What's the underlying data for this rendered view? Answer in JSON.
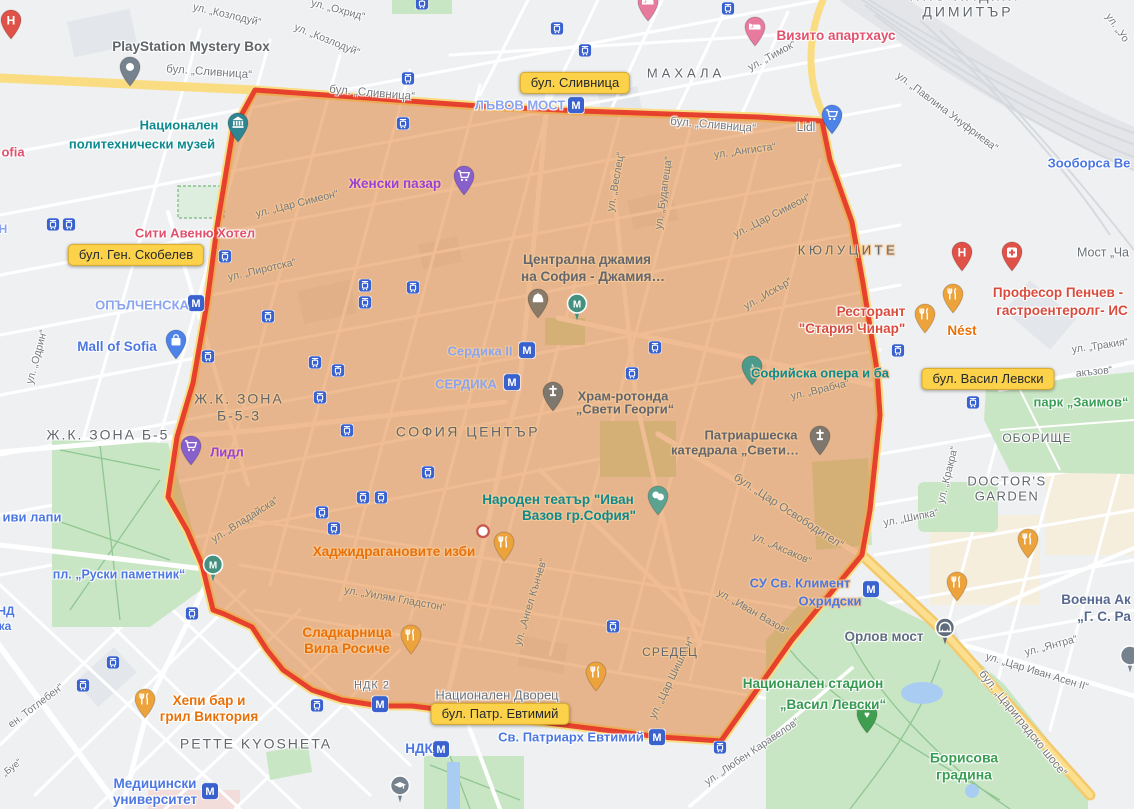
{
  "map": {
    "city": "София",
    "zone_stroke": "#e53b2c",
    "zone_fill": "#e07a28",
    "badge_bg": "#fcd24a"
  },
  "badges": [
    {
      "t": "бул. Сливница",
      "x": 575,
      "y": 83,
      "n": "badge-slivnitsa"
    },
    {
      "t": "бул. Ген. Скобелев",
      "x": 136,
      "y": 255,
      "n": "badge-skobelev"
    },
    {
      "t": "бул. Васил Левски",
      "x": 988,
      "y": 379,
      "n": "badge-vasil-levski"
    },
    {
      "t": "бул. Патр. Евтимий",
      "x": 500,
      "y": 714,
      "n": "badge-patr-evtimiy"
    }
  ],
  "labels": [
    {
      "t": "ул. „Козлодуй“",
      "x": 227,
      "y": 15,
      "k": "street",
      "r": 13
    },
    {
      "t": "ул. „Охрид“",
      "x": 338,
      "y": 10,
      "k": "street",
      "r": 15
    },
    {
      "t": "ул. „Козлодуй“",
      "x": 327,
      "y": 40,
      "k": "street",
      "r": 22
    },
    {
      "t": "бул. „Сливница“",
      "x": 209,
      "y": 73,
      "k": "street",
      "r": 4,
      "s": 11.5
    },
    {
      "t": "бул. „Сливница“",
      "x": 372,
      "y": 94,
      "k": "street",
      "r": 5,
      "s": 11.5
    },
    {
      "t": "бул. „Сливница“",
      "x": 713,
      "y": 126,
      "k": "street",
      "r": 5,
      "s": 11.5
    },
    {
      "t": "ул. „Тимок“",
      "x": 772,
      "y": 56,
      "k": "street",
      "r": -28
    },
    {
      "t": "ул. „Павлина Унуфриева“",
      "x": 947,
      "y": 112,
      "k": "street",
      "r": 37
    },
    {
      "t": "ул. „Уо",
      "x": 1117,
      "y": 28,
      "k": "street",
      "r": 55
    },
    {
      "t": "ул. „Ангиста“",
      "x": 745,
      "y": 151,
      "k": "street",
      "r": -8,
      "h": 1
    },
    {
      "t": "ул. „Цар Симеон“",
      "x": 297,
      "y": 204,
      "k": "street",
      "r": -14,
      "h": 1
    },
    {
      "t": "ул. „Цар Симеон“",
      "x": 772,
      "y": 216,
      "k": "street",
      "r": -27,
      "h": 1
    },
    {
      "t": "ул. „Веслец“",
      "x": 616,
      "y": 182,
      "k": "street",
      "r": -80,
      "h": 1
    },
    {
      "t": "ул. „Будапеща“",
      "x": 664,
      "y": 193,
      "k": "street",
      "r": -82,
      "h": 1
    },
    {
      "t": "ул. „Пиротска“",
      "x": 262,
      "y": 270,
      "k": "street",
      "r": -13,
      "h": 1
    },
    {
      "t": "ул. „Искър“",
      "x": 768,
      "y": 294,
      "k": "street",
      "r": -30,
      "h": 1
    },
    {
      "t": "ул. „Врабча“",
      "x": 820,
      "y": 390,
      "k": "street",
      "r": -13,
      "h": 1
    },
    {
      "t": "ул. „Одрин“",
      "x": 37,
      "y": 357,
      "k": "street",
      "r": -75
    },
    {
      "t": "ул. „Тракия“",
      "x": 1100,
      "y": 346,
      "k": "street",
      "r": -8
    },
    {
      "t": "акъзов“",
      "x": 1094,
      "y": 372,
      "k": "street",
      "r": -6
    },
    {
      "t": "ул. „Кракра“",
      "x": 948,
      "y": 475,
      "k": "street",
      "r": -76
    },
    {
      "t": "ул. „Шипка“",
      "x": 911,
      "y": 518,
      "k": "street",
      "r": -11
    },
    {
      "t": "бул. „Цар Освободител“",
      "x": 788,
      "y": 512,
      "k": "street",
      "r": 33,
      "s": 11.5,
      "h": 1
    },
    {
      "t": "ул. „Аксаков“",
      "x": 782,
      "y": 549,
      "k": "street",
      "r": 24,
      "h": 1
    },
    {
      "t": "ул. „Иван Вазов“",
      "x": 753,
      "y": 612,
      "k": "street",
      "r": 30,
      "h": 1
    },
    {
      "t": "ул. „Цар Шишман“",
      "x": 672,
      "y": 678,
      "k": "street",
      "r": -64,
      "h": 1
    },
    {
      "t": "ул. „Ангел Кънчев“",
      "x": 531,
      "y": 602,
      "k": "street",
      "r": -73,
      "h": 1
    },
    {
      "t": "ул. „Уилям Гладстон“",
      "x": 395,
      "y": 599,
      "k": "street",
      "r": 10,
      "h": 1
    },
    {
      "t": "ул. „Владайска“",
      "x": 245,
      "y": 520,
      "k": "street",
      "r": -32,
      "h": 1
    },
    {
      "t": "ул. „Любен Каравелов“",
      "x": 752,
      "y": 752,
      "k": "street",
      "r": -34
    },
    {
      "t": "ул. „Янтра“",
      "x": 1051,
      "y": 646,
      "k": "street",
      "r": -15
    },
    {
      "t": "ул. „Цар Иван Асен II“",
      "x": 1037,
      "y": 672,
      "k": "street",
      "r": 17
    },
    {
      "t": "бул. „Цариградско шосе“",
      "x": 1022,
      "y": 724,
      "k": "street",
      "r": 51,
      "s": 11.5
    },
    {
      "t": "ен. Тотлебен“",
      "x": 36,
      "y": 706,
      "k": "street",
      "r": -37
    },
    {
      "t": "„Буе“",
      "x": 12,
      "y": 768,
      "k": "street",
      "r": -38,
      "s": 9.5
    },
    {
      "t": "Мост „Ча",
      "x": 1103,
      "y": 253,
      "k": "dim",
      "s": 12.5
    },
    {
      "t": "Lidl",
      "x": 806,
      "y": 127,
      "k": "dim",
      "s": 12
    },
    {
      "t": "НДК 2",
      "x": 372,
      "y": 686,
      "k": "dim",
      "s": 11,
      "ls": 1
    },
    {
      "t": "Национален Дворец",
      "x": 497,
      "y": 695,
      "k": "dim",
      "s": 13
    },
    {
      "t": "НПЗ ХАДЖИ",
      "x": 965,
      "y": -4,
      "k": "area",
      "s": 14,
      "ls": 3
    },
    {
      "t": "ДИМИТЪР",
      "x": 968,
      "y": 12,
      "k": "area",
      "s": 14,
      "ls": 3
    },
    {
      "t": "МАХАЛА",
      "x": 686,
      "y": 73,
      "k": "area",
      "s": 13,
      "ls": 4
    },
    {
      "t": "КЮЛУЦИТЕ",
      "x": 848,
      "y": 250,
      "k": "area",
      "s": 13,
      "ls": 3.5,
      "h": 1
    },
    {
      "t": "Ж.К. ЗОНА Б-5",
      "x": 108,
      "y": 435,
      "k": "area",
      "s": 14,
      "ls": 2
    },
    {
      "t": "Ж.К. ЗОНА\nБ-5-3",
      "x": 239,
      "y": 407,
      "k": "area",
      "s": 14,
      "ls": 2,
      "h": 1
    },
    {
      "t": "СОФИЯ ЦЕНТЪР",
      "x": 468,
      "y": 432,
      "k": "area",
      "s": 14,
      "ls": 2.5,
      "h": 1
    },
    {
      "t": "СРЕДЕЦ",
      "x": 670,
      "y": 652,
      "k": "area",
      "s": 12,
      "ls": 1,
      "h": 1
    },
    {
      "t": "PETTE KYOSHETA",
      "x": 256,
      "y": 744,
      "k": "area",
      "s": 14,
      "ls": 2
    },
    {
      "t": "ОБОРИЩЕ",
      "x": 1037,
      "y": 438,
      "k": "area",
      "s": 12,
      "ls": 1
    },
    {
      "t": "DOCTOR'S\nGARDEN",
      "x": 1007,
      "y": 489,
      "k": "area",
      "s": 13,
      "ls": 1.5
    },
    {
      "t": "ЛЪВОВ МОСТ",
      "x": 520,
      "y": 105,
      "k": "stationlight",
      "s": 13
    },
    {
      "t": "ОПЪЛЧЕНСКА",
      "x": 142,
      "y": 305,
      "k": "stationlight",
      "s": 13
    },
    {
      "t": "Сердика II",
      "x": 480,
      "y": 351,
      "k": "stationlight",
      "s": 13,
      "h": 1
    },
    {
      "t": "СЕРДИКА",
      "x": 466,
      "y": 384,
      "k": "stationlight",
      "s": 13,
      "h": 1
    },
    {
      "t": "Н",
      "x": 3,
      "y": 229,
      "k": "stationlight",
      "s": 12
    },
    {
      "t": "Mall of Sofia",
      "x": 117,
      "y": 347,
      "k": "station",
      "s": 13.5
    },
    {
      "t": "иви лапи",
      "x": 32,
      "y": 517,
      "k": "station",
      "s": 13
    },
    {
      "t": "пл. „Руски паметник“",
      "x": 119,
      "y": 575,
      "k": "station",
      "s": 12.5
    },
    {
      "t": "Зооборса Ве",
      "x": 1089,
      "y": 163,
      "k": "station",
      "s": 13
    },
    {
      "t": "НД",
      "x": 6,
      "y": 611,
      "k": "station",
      "s": 12
    },
    {
      "t": "ка",
      "x": 5,
      "y": 626,
      "k": "station",
      "s": 12
    },
    {
      "t": "СУ Св. Климент",
      "x": 800,
      "y": 583,
      "k": "station",
      "s": 13,
      "h": 1
    },
    {
      "t": "Охридски",
      "x": 830,
      "y": 601,
      "k": "station",
      "s": 13,
      "h": 1
    },
    {
      "t": "Св. Патриарх Евтимий",
      "x": 571,
      "y": 737,
      "k": "station",
      "s": 13
    },
    {
      "t": "НДК",
      "x": 419,
      "y": 749,
      "k": "station",
      "s": 13.5
    },
    {
      "t": "Медицински\nуниверситет",
      "x": 155,
      "y": 792,
      "k": "station",
      "s": 13.5
    },
    {
      "t": "Национален",
      "x": 179,
      "y": 125,
      "k": "teal",
      "s": 13
    },
    {
      "t": "политехнически музей",
      "x": 142,
      "y": 144,
      "k": "teal",
      "s": 13
    },
    {
      "t": "Народен театър \"Иван",
      "x": 558,
      "y": 500,
      "k": "teal",
      "s": 13.5,
      "h": 1
    },
    {
      "t": "Вазов гр.София\"",
      "x": 579,
      "y": 516,
      "k": "teal",
      "s": 13.5,
      "h": 1
    },
    {
      "t": "Софийска опера и ба",
      "x": 820,
      "y": 373,
      "k": "teal",
      "s": 13,
      "h": 1
    },
    {
      "t": "Централна джамия",
      "x": 587,
      "y": 260,
      "k": "poigray",
      "s": 13.5,
      "h": 1
    },
    {
      "t": "на София - Джамия…",
      "x": 593,
      "y": 277,
      "k": "poigray",
      "s": 13.5,
      "h": 1
    },
    {
      "t": "Храм-ротонда",
      "x": 623,
      "y": 396,
      "k": "poigray",
      "s": 13,
      "h": 1
    },
    {
      "t": "„Свети Георги“",
      "x": 625,
      "y": 409,
      "k": "poigray",
      "s": 13,
      "h": 1
    },
    {
      "t": "Патриаршеска",
      "x": 751,
      "y": 435,
      "k": "poigray",
      "s": 13,
      "h": 1
    },
    {
      "t": "катедрала „Свети…",
      "x": 735,
      "y": 450,
      "k": "poigray",
      "s": 13,
      "h": 1
    },
    {
      "t": "PlayStation Mystery Box",
      "x": 191,
      "y": 47,
      "k": "gray",
      "s": 13.5
    },
    {
      "t": "Орлов мост",
      "x": 884,
      "y": 637,
      "k": "slate",
      "s": 13.5
    },
    {
      "t": "Военна Ак",
      "x": 1096,
      "y": 600,
      "k": "navy",
      "s": 13.5
    },
    {
      "t": "„Г. С. Ра",
      "x": 1104,
      "y": 617,
      "k": "navy",
      "s": 13.5
    },
    {
      "t": "парк „Заимов“",
      "x": 1081,
      "y": 402,
      "k": "green",
      "s": 13
    },
    {
      "t": "Борисова\nградина",
      "x": 964,
      "y": 766,
      "k": "green",
      "s": 14
    },
    {
      "t": "Национален стадион",
      "x": 813,
      "y": 684,
      "k": "greendark",
      "s": 13.5
    },
    {
      "t": "„Васил Левски“",
      "x": 833,
      "y": 705,
      "k": "greendark",
      "s": 13.5
    },
    {
      "t": "Женски пазар",
      "x": 395,
      "y": 184,
      "k": "purple",
      "s": 13.5,
      "h": 1
    },
    {
      "t": "Лидл",
      "x": 227,
      "y": 452,
      "k": "purple",
      "s": 13,
      "h": 1
    },
    {
      "t": "Хаджидрагановите изби",
      "x": 394,
      "y": 552,
      "k": "orange",
      "s": 13.5,
      "h": 1
    },
    {
      "t": "Сладкарница\nВила Росиче",
      "x": 347,
      "y": 641,
      "k": "orange",
      "s": 13.5,
      "h": 1
    },
    {
      "t": "Хепи бар и\nгрил Виктория",
      "x": 209,
      "y": 709,
      "k": "orange",
      "s": 13.5
    },
    {
      "t": "Nést",
      "x": 962,
      "y": 331,
      "k": "orange",
      "s": 13.5
    },
    {
      "t": "Професор Пенчев -",
      "x": 1058,
      "y": 293,
      "k": "red",
      "s": 13.5
    },
    {
      "t": "гастроентеролг- ИС",
      "x": 1062,
      "y": 311,
      "k": "red",
      "s": 13.5
    },
    {
      "t": "Ресторант",
      "x": 871,
      "y": 312,
      "k": "red",
      "s": 13.5
    },
    {
      "t": "\"Стария Чинар\"",
      "x": 852,
      "y": 329,
      "k": "red",
      "s": 13.5
    },
    {
      "t": "Визито апартхаус",
      "x": 836,
      "y": 36,
      "k": "pink",
      "s": 13.5
    },
    {
      "t": "Сити Авеню Хотел",
      "x": 195,
      "y": 233,
      "k": "pink",
      "s": 13
    },
    {
      "t": "ofia",
      "x": 13,
      "y": 152,
      "k": "pink",
      "s": 13
    }
  ],
  "icons": [
    {
      "t": "metro",
      "x": 576,
      "y": 106
    },
    {
      "t": "metro",
      "x": 196,
      "y": 304
    },
    {
      "t": "metro",
      "x": 527,
      "y": 351
    },
    {
      "t": "metro",
      "x": 512,
      "y": 383
    },
    {
      "t": "metro",
      "x": 871,
      "y": 590
    },
    {
      "t": "metro",
      "x": 657,
      "y": 738
    },
    {
      "t": "metro",
      "x": 441,
      "y": 750
    },
    {
      "t": "metro",
      "x": 210,
      "y": 792
    },
    {
      "t": "metro",
      "x": 380,
      "y": 705
    },
    {
      "t": "tram",
      "x": 422,
      "y": 4
    },
    {
      "t": "tram",
      "x": 557,
      "y": 29
    },
    {
      "t": "tram",
      "x": 585,
      "y": 51
    },
    {
      "t": "tram",
      "x": 408,
      "y": 79
    },
    {
      "t": "tram",
      "x": 728,
      "y": 9
    },
    {
      "t": "tram",
      "x": 403,
      "y": 124
    },
    {
      "t": "tram",
      "x": 53,
      "y": 225
    },
    {
      "t": "tram",
      "x": 69,
      "y": 225
    },
    {
      "t": "tram",
      "x": 225,
      "y": 257
    },
    {
      "t": "tram",
      "x": 268,
      "y": 317
    },
    {
      "t": "tram",
      "x": 208,
      "y": 357
    },
    {
      "t": "tram",
      "x": 365,
      "y": 286
    },
    {
      "t": "tram",
      "x": 365,
      "y": 303
    },
    {
      "t": "tram",
      "x": 413,
      "y": 288
    },
    {
      "t": "tram",
      "x": 315,
      "y": 363
    },
    {
      "t": "tram",
      "x": 338,
      "y": 371
    },
    {
      "t": "tram",
      "x": 320,
      "y": 398
    },
    {
      "t": "tram",
      "x": 655,
      "y": 348
    },
    {
      "t": "tram",
      "x": 632,
      "y": 374
    },
    {
      "t": "tram",
      "x": 898,
      "y": 351
    },
    {
      "t": "tram",
      "x": 973,
      "y": 403
    },
    {
      "t": "tram",
      "x": 347,
      "y": 431
    },
    {
      "t": "tram",
      "x": 363,
      "y": 498
    },
    {
      "t": "tram",
      "x": 381,
      "y": 498
    },
    {
      "t": "tram",
      "x": 322,
      "y": 513
    },
    {
      "t": "tram",
      "x": 334,
      "y": 529
    },
    {
      "t": "tram",
      "x": 428,
      "y": 473
    },
    {
      "t": "tram",
      "x": 613,
      "y": 627
    },
    {
      "t": "tram",
      "x": 192,
      "y": 614
    },
    {
      "t": "tram",
      "x": 113,
      "y": 663
    },
    {
      "t": "tram",
      "x": 83,
      "y": 686
    },
    {
      "t": "tram",
      "x": 317,
      "y": 706
    },
    {
      "t": "tram",
      "x": 720,
      "y": 748
    },
    {
      "t": "hospital-h",
      "x": 11,
      "y": 26
    },
    {
      "t": "hospital-h",
      "x": 962,
      "y": 258
    },
    {
      "t": "hospital-plus",
      "x": 1012,
      "y": 258
    },
    {
      "t": "hotel",
      "x": 648,
      "y": 8
    },
    {
      "t": "hotel",
      "x": 755,
      "y": 33
    },
    {
      "t": "playstation",
      "x": 130,
      "y": 73
    },
    {
      "t": "museum",
      "x": 238,
      "y": 129
    },
    {
      "t": "cart-purple",
      "x": 464,
      "y": 182
    },
    {
      "t": "cart-purple",
      "x": 191,
      "y": 452
    },
    {
      "t": "cart-blue",
      "x": 832,
      "y": 121
    },
    {
      "t": "bag",
      "x": 176,
      "y": 346
    },
    {
      "t": "mosque",
      "x": 538,
      "y": 305
    },
    {
      "t": "monument",
      "x": 577,
      "y": 309
    },
    {
      "t": "monument",
      "x": 213,
      "y": 570
    },
    {
      "t": "church",
      "x": 553,
      "y": 398
    },
    {
      "t": "church",
      "x": 820,
      "y": 442
    },
    {
      "t": "music",
      "x": 752,
      "y": 372
    },
    {
      "t": "theater",
      "x": 658,
      "y": 502
    },
    {
      "t": "food",
      "x": 925,
      "y": 320
    },
    {
      "t": "food",
      "x": 953,
      "y": 300
    },
    {
      "t": "food",
      "x": 504,
      "y": 548
    },
    {
      "t": "food",
      "x": 411,
      "y": 641
    },
    {
      "t": "food",
      "x": 145,
      "y": 705
    },
    {
      "t": "food",
      "x": 596,
      "y": 678
    },
    {
      "t": "food",
      "x": 1028,
      "y": 545
    },
    {
      "t": "food",
      "x": 957,
      "y": 588
    },
    {
      "t": "bridge",
      "x": 945,
      "y": 633
    },
    {
      "t": "grad",
      "x": 400,
      "y": 791
    },
    {
      "t": "hands",
      "x": 867,
      "y": 720
    },
    {
      "t": "place-dot",
      "x": 483,
      "y": 532
    },
    {
      "t": "generic",
      "x": 1130,
      "y": 661
    }
  ]
}
